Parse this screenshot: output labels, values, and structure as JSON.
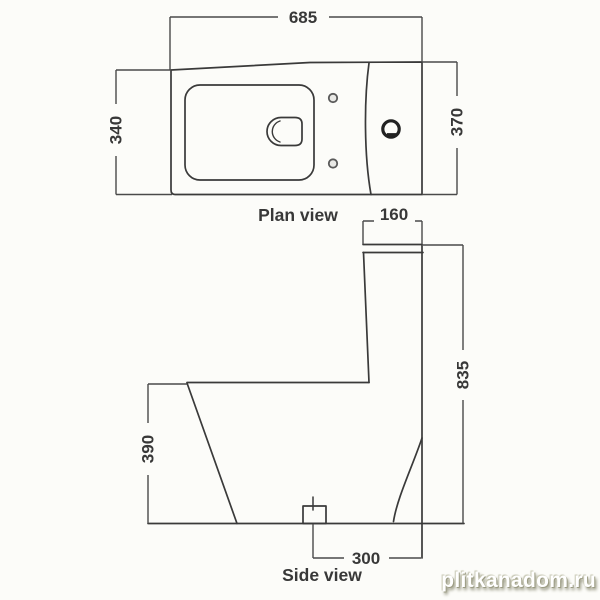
{
  "plan_view": {
    "label": "Plan view",
    "dims": {
      "width": "685",
      "depth_left": "340",
      "depth_right": "370"
    }
  },
  "side_view": {
    "label": "Side view",
    "dims": {
      "tank_top_width": "160",
      "total_height": "835",
      "front_height": "390",
      "outlet_offset": "300"
    }
  },
  "watermark": "plitkanadom.ru",
  "colors": {
    "body_line": "#3a3a3a",
    "dimension_line": "#4a4a4a",
    "text": "#383838",
    "background": "#fcfcf9",
    "watermark_fill": "#ffffff",
    "watermark_shadow": "#9c9c84"
  }
}
